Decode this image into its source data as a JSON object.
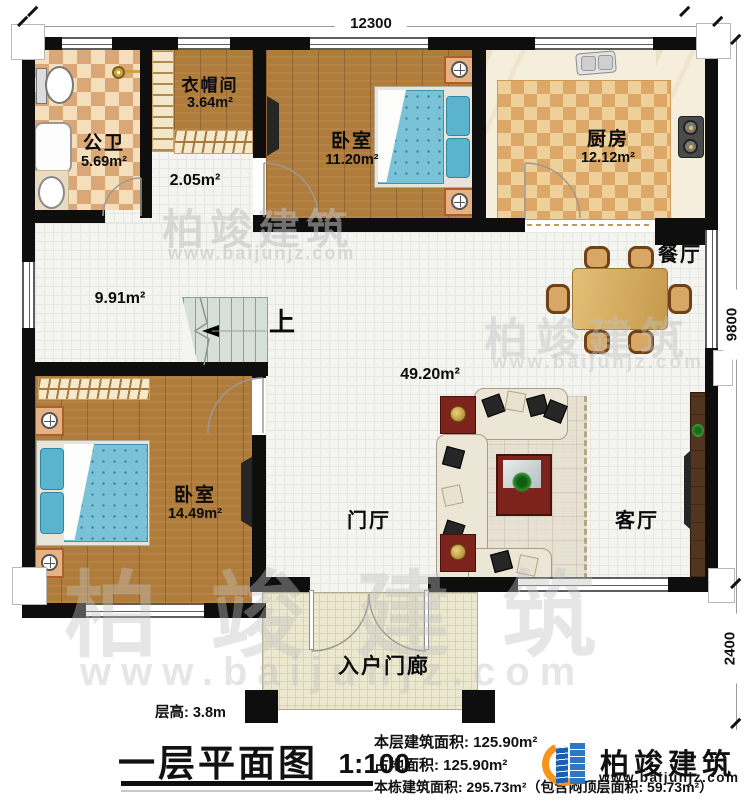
{
  "dimensions": {
    "top": "12300",
    "right_upper": "9800",
    "right_lower": "2400"
  },
  "rooms": {
    "bathroom": {
      "name": "公卫",
      "area": "5.69m²"
    },
    "cloakroom": {
      "name": "衣帽间",
      "area": "3.64m²"
    },
    "hallway_small": {
      "area": "2.05m²"
    },
    "bedroom1": {
      "name": "卧室",
      "area": "11.20m²"
    },
    "kitchen": {
      "name": "厨房",
      "area": "12.12m²"
    },
    "dining": {
      "name": "餐厅"
    },
    "hallway": {
      "area": "9.91m²"
    },
    "great_room": {
      "area": "49.20m²"
    },
    "bedroom2": {
      "name": "卧室",
      "area": "14.49m²"
    },
    "foyer": {
      "name": "门厅"
    },
    "living": {
      "name": "客厅"
    },
    "porch": {
      "name": "入户门廊"
    }
  },
  "stairs": {
    "up_label": "上"
  },
  "notes": {
    "floor_height": "层高: 3.8m"
  },
  "title": {
    "text": "一层平面图",
    "scale": "1:100"
  },
  "stats": {
    "floor_area": "本层建筑面积: 125.90m²",
    "footprint_area": "占地面积: 125.90m²",
    "building_total": "本栋建筑面积: 295.73m²（包含闷顶层面积: 59.73m²）"
  },
  "brand": {
    "name": "柏竣建筑",
    "website": "www.baijunjz.com"
  },
  "watermark": {
    "name": "柏竣建筑",
    "website": "www.baijunjz.com"
  },
  "colors": {
    "wall": "#0e0e0e",
    "wood": "#b07c3c",
    "tile": "#f4f4f1",
    "brand_blue": "#1b5fae",
    "brand_orange": "#f7941d"
  }
}
